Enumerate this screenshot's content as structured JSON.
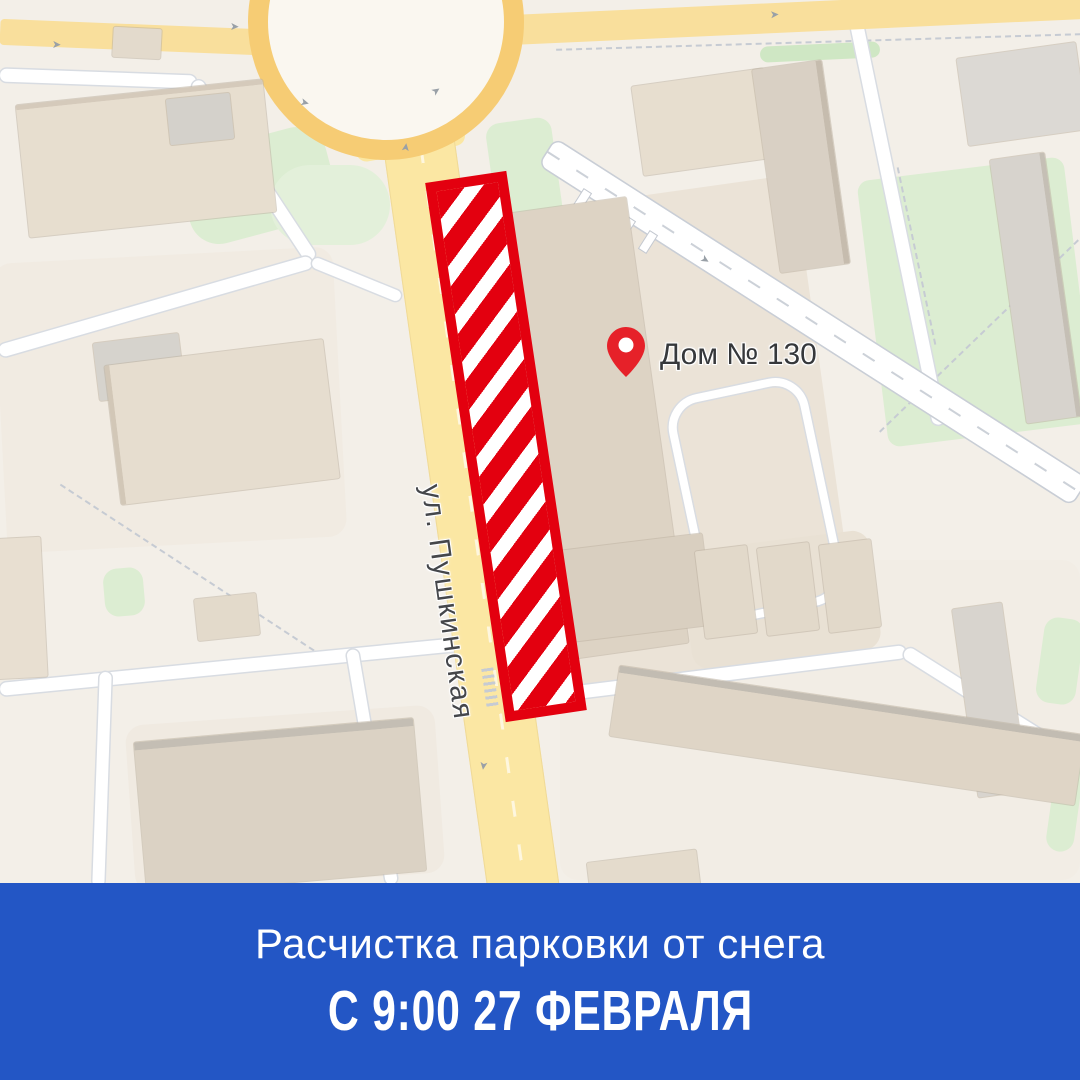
{
  "map": {
    "street_label": "ул. Пушкинская",
    "house_label": "Дом № 130",
    "pin_icon": "location-pin-icon"
  },
  "banner": {
    "title": "Расчистка парковки от снега",
    "subtitle": "С 9:00 27 ФЕВРАЛЯ",
    "background_color": "#2356C5",
    "text_color": "#FFFFFF"
  },
  "colors": {
    "map_background": "#F3EFE8",
    "main_road_yellow": "#FBE7A3",
    "roundabout_orange": "#F6CC74",
    "minor_road_white": "#FFFFFF",
    "green_area": "#DCEDD2",
    "building_beige": "#E7DECF",
    "restricted_zone_red": "#E3000F",
    "pin_red": "#E62129",
    "label_text": "#45474B"
  }
}
